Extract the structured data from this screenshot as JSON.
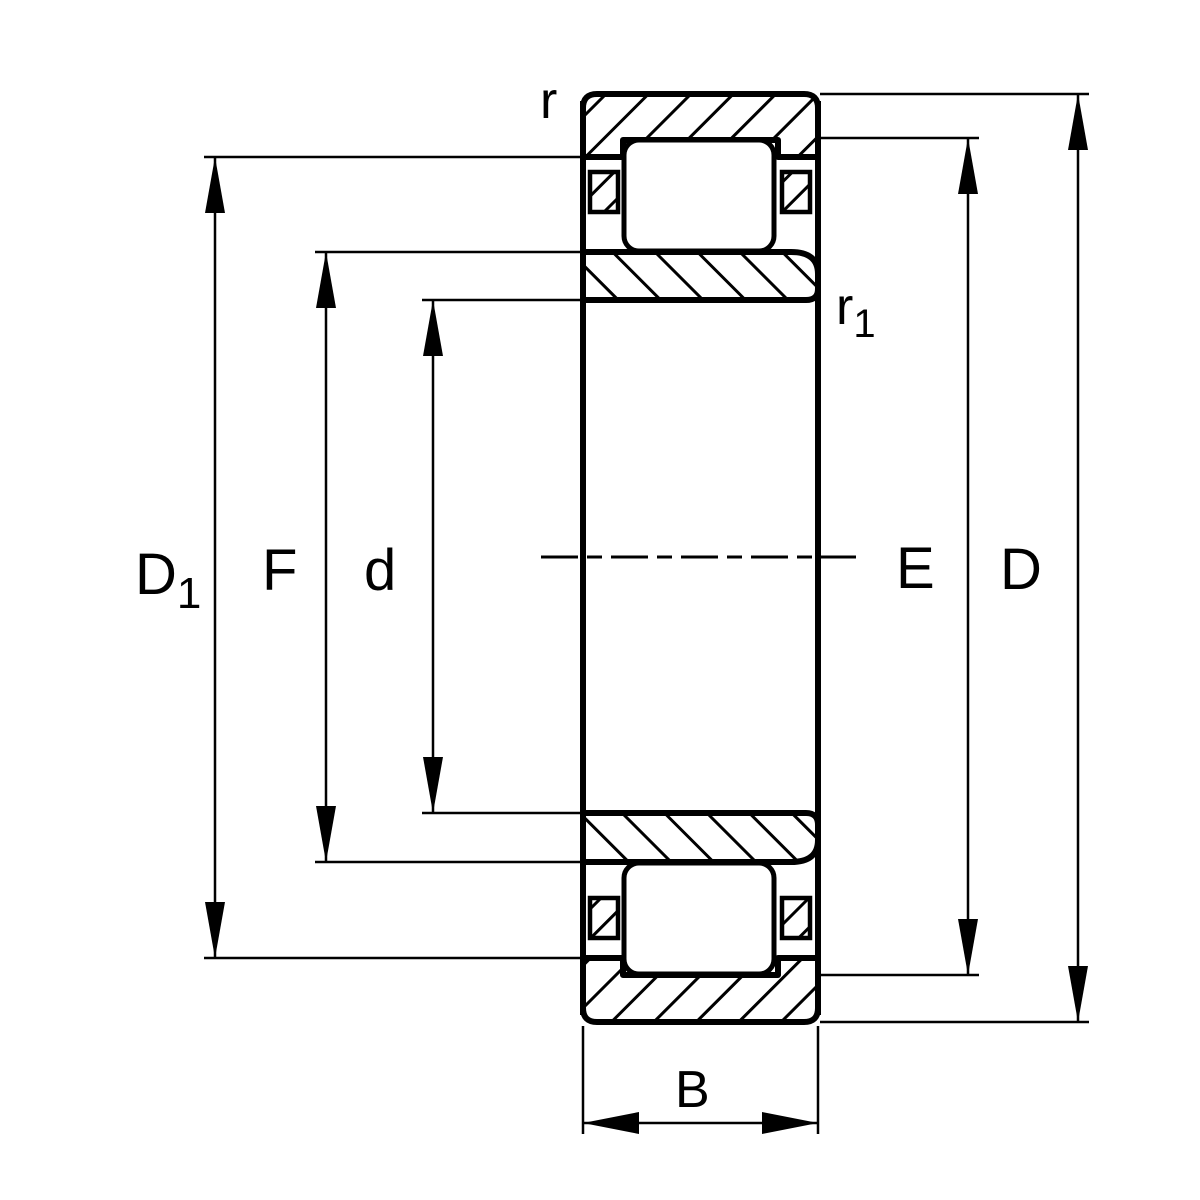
{
  "colors": {
    "background": "#ffffff",
    "line": "#000000"
  },
  "labels": {
    "d1": {
      "base": "D",
      "sub": "1"
    },
    "f": {
      "base": "F"
    },
    "d": {
      "base": "d"
    },
    "e": {
      "base": "E"
    },
    "D": {
      "base": "D"
    },
    "b": {
      "base": "B"
    },
    "r": {
      "base": "r"
    },
    "r1": {
      "base": "r",
      "sub": "1"
    }
  }
}
